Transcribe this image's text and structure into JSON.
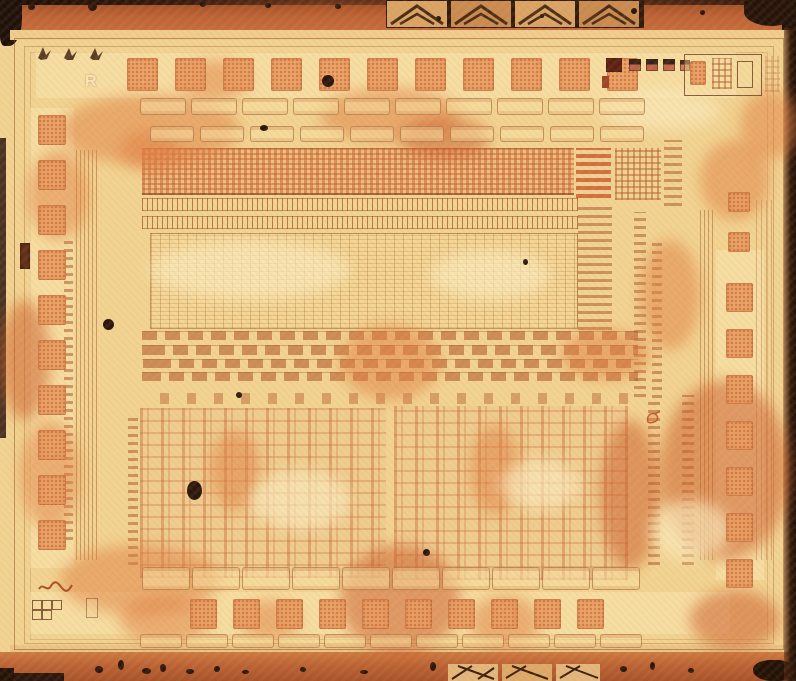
{
  "image": {
    "kind": "integrated-circuit die photograph",
    "marking_letter": "R",
    "chevron_alignment_tiles": 4,
    "process_test_squares": 5,
    "bond_pads": {
      "top": 11,
      "bottom": 10,
      "left": 10,
      "right": 7
    },
    "palette": {
      "base_pale_yellow": "#f2d492",
      "cream_highlight": "#f9e9bb",
      "stain_orange": "#df7d42",
      "deep_orange": "#c05f33",
      "band_orange_red": "#b85c32",
      "texture_brown": "#a05a2e",
      "dark_edge_brown": "#241309",
      "test_square_dark_red": "#5c1f10"
    }
  }
}
